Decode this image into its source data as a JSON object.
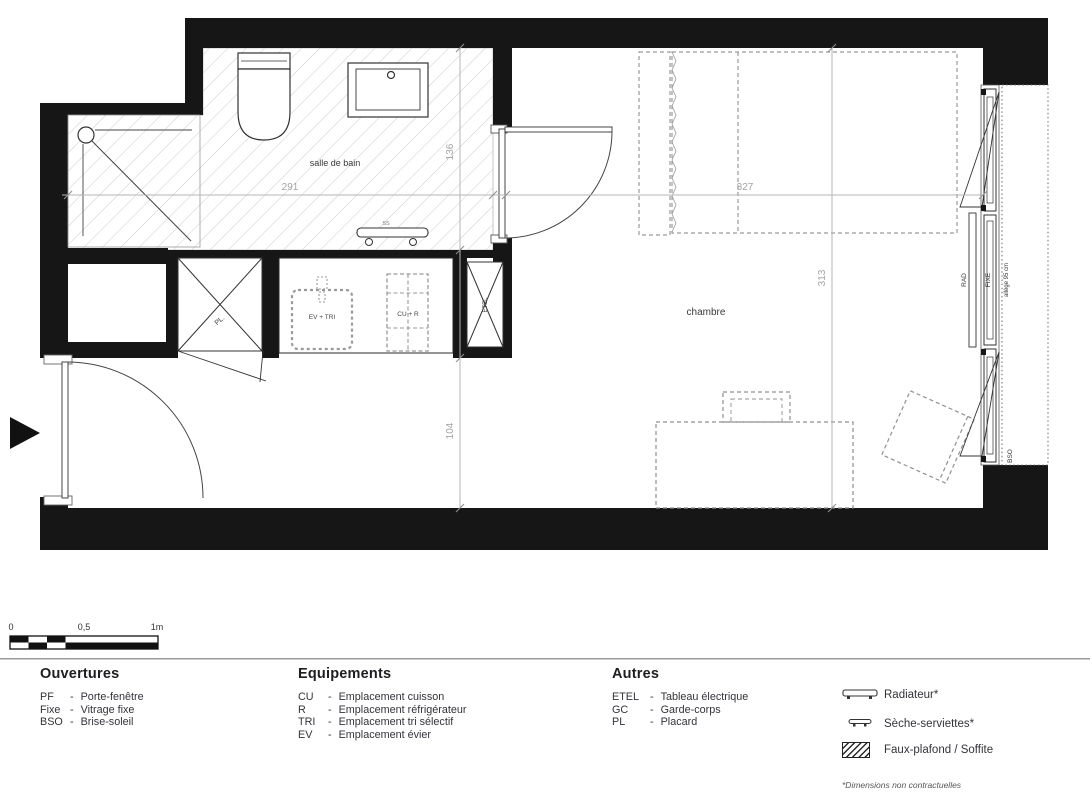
{
  "plan": {
    "room_labels": {
      "bathroom": "salle de bain",
      "bedroom": "chambre"
    },
    "dimensions": {
      "bathroom_width": "291",
      "bathroom_height": "136",
      "bedroom_width": "327",
      "bedroom_height": "313",
      "hall_width": "104"
    },
    "fixture_labels": {
      "closet": "PL.",
      "sink_sorting": "EV + TRI",
      "cooking_fridge": "CU + R",
      "electrical_panel": "ETEL",
      "towel_dryer": "SS",
      "radiator": "RAD",
      "fixed_glazing": "FIXE",
      "window_sill": "allège 95 cm",
      "sun_screen": "BSO"
    }
  },
  "scale_bar": {
    "tick_0": "0",
    "tick_mid": "0,5",
    "tick_end": "1m"
  },
  "legend": {
    "dash": "-",
    "sections": {
      "ouvertures": {
        "title": "Ouvertures",
        "items": [
          {
            "abbr": "PF",
            "label": "Porte-fenêtre"
          },
          {
            "abbr": "Fixe",
            "label": "Vitrage fixe"
          },
          {
            "abbr": "BSO",
            "label": "Brise-soleil"
          }
        ]
      },
      "equipements": {
        "title": "Equipements",
        "items": [
          {
            "abbr": "CU",
            "label": "Emplacement cuisson"
          },
          {
            "abbr": "R",
            "label": "Emplacement réfrigérateur"
          },
          {
            "abbr": "TRI",
            "label": "Emplacement tri sélectif"
          },
          {
            "abbr": "EV",
            "label": "Emplacement évier"
          }
        ]
      },
      "autres": {
        "title": "Autres",
        "items": [
          {
            "abbr": "ETEL",
            "label": "Tableau électrique"
          },
          {
            "abbr": "GC",
            "label": "Garde-corps"
          },
          {
            "abbr": "PL",
            "label": "Placard"
          }
        ]
      }
    },
    "symbols": [
      {
        "name": "radiateur",
        "label": "Radiateur*"
      },
      {
        "name": "seche-serviettes",
        "label": "Sèche-serviettes*"
      },
      {
        "name": "faux-plafond",
        "label": "Faux-plafond / Soffite"
      }
    ],
    "footnote": "*Dimensions non contractuelles"
  },
  "colors": {
    "wall": "#161616",
    "dim_line": "#b5b5b5",
    "dim_text": "#a3a3a3",
    "hatch": "#cccccc",
    "dashed": "#909090"
  }
}
